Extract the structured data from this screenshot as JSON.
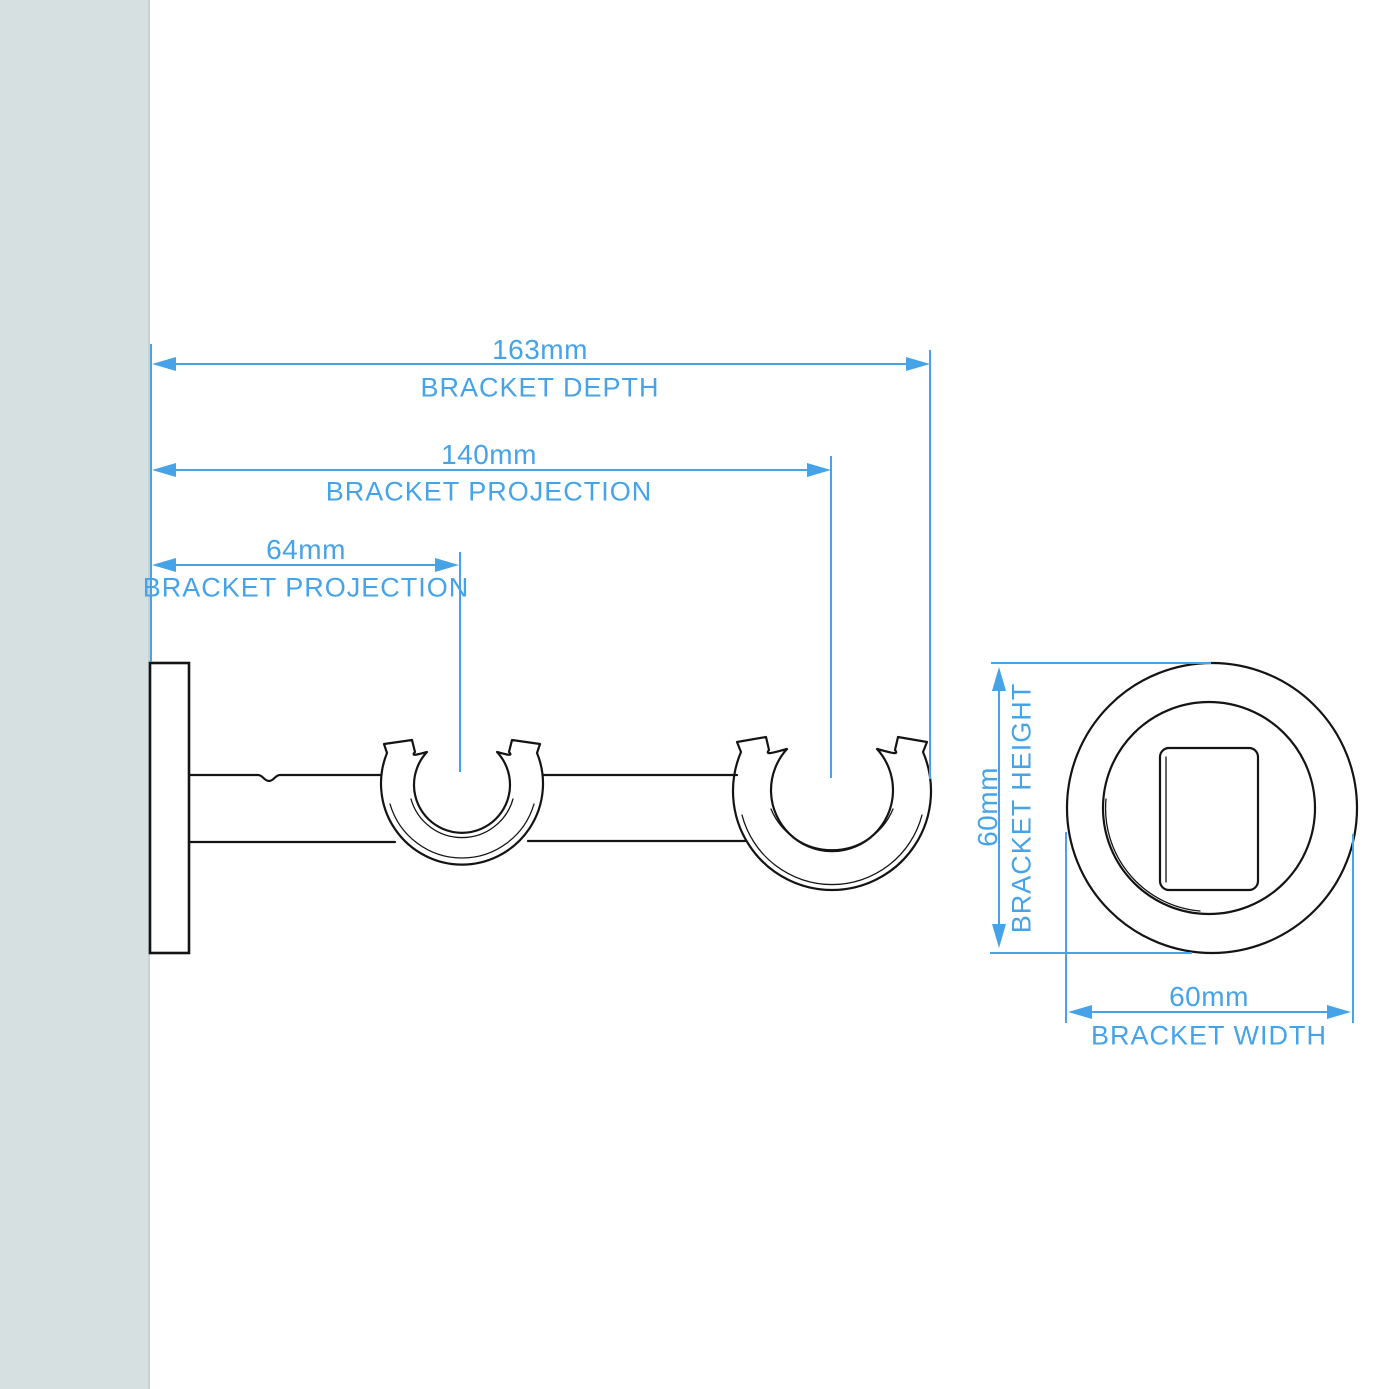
{
  "colors": {
    "accent": "#46a3e8",
    "line": "#141414",
    "wall": "#d7e0e0"
  },
  "side_view": {
    "depth": {
      "value": "163mm",
      "label": "BRACKET DEPTH"
    },
    "projection_full": {
      "value": "140mm",
      "label": "BRACKET PROJECTION"
    },
    "projection_inner": {
      "value": "64mm",
      "label": "BRACKET PROJECTION"
    }
  },
  "front_view": {
    "height": {
      "value": "60mm",
      "label": "BRACKET HEIGHT"
    },
    "width": {
      "value": "60mm",
      "label": "BRACKET WIDTH"
    }
  }
}
